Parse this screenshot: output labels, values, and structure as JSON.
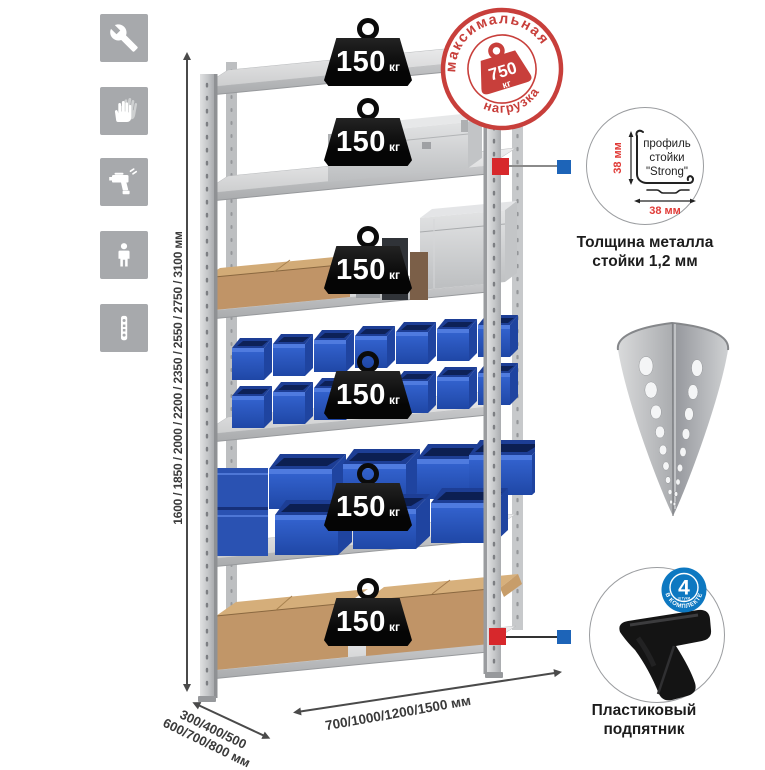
{
  "canvas": {
    "bg": "#ffffff"
  },
  "side_icons": [
    {
      "name": "wrench-icon"
    },
    {
      "name": "gloves-icon"
    },
    {
      "name": "drill-icon"
    },
    {
      "name": "person-icon"
    },
    {
      "name": "rack-post-icon"
    }
  ],
  "stamp": {
    "arc_top": "максимальная",
    "arc_bottom": "нагрузка",
    "value": "750",
    "unit": "кг"
  },
  "shelf_weights": [
    {
      "value": "150",
      "unit": "кг"
    },
    {
      "value": "150",
      "unit": "кг"
    },
    {
      "value": "150",
      "unit": "кг"
    },
    {
      "value": "150",
      "unit": "кг"
    },
    {
      "value": "150",
      "unit": "кг"
    },
    {
      "value": "150",
      "unit": "кг"
    }
  ],
  "dimensions": {
    "height": "1600 / 1850 / 2000 / 2200 / 2350 / 2550 / 2750 / 3100 мм",
    "depth_line1": "300/400/500",
    "depth_line2": "600/700/800 мм",
    "width": "700/1000/1200/1500 мм"
  },
  "profile_detail": {
    "label_line1": "профиль",
    "label_line2": "стойки",
    "label_line3": "\"Strong\"",
    "dim_vertical": "38 мм",
    "dim_horizontal": "38 мм",
    "caption_line1": "Толщина металла",
    "caption_line2": "стойки 1,2 мм"
  },
  "foot_detail": {
    "badge_value": "4",
    "badge_sub": "штуки",
    "badge_ring_text": "В КОМПЛЕКТЕ",
    "caption_line1": "Пластиковый",
    "caption_line2": "подпятник"
  },
  "colors": {
    "stamp_red": "#c83f3b",
    "marker_red": "#d7282c",
    "marker_blue": "#1d64b8",
    "bin_blue": "#2e5dc6",
    "icon_bg": "#a7a9ac"
  }
}
